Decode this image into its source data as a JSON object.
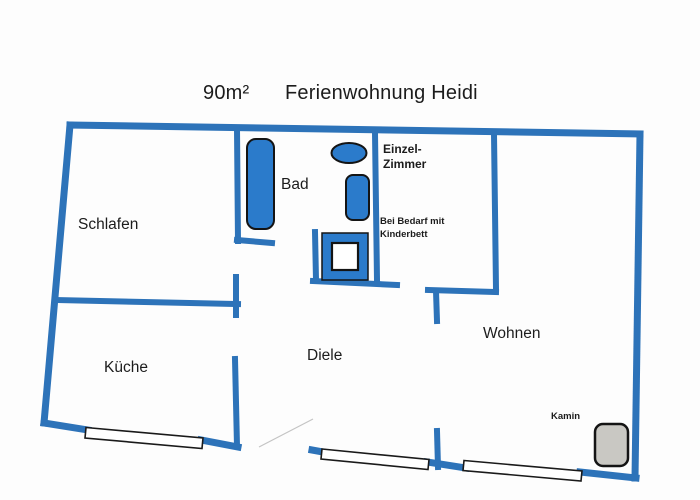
{
  "title": {
    "area": "90m²",
    "name": "Ferienwohnung Heidi"
  },
  "rooms": {
    "schlafen": {
      "label": "Schlafen"
    },
    "bad": {
      "label": "Bad"
    },
    "einzelzimmer": {
      "label_line1": "Einzel-",
      "label_line2": "Zimmer",
      "note_line1": "Bei Bedarf mit",
      "note_line2": "Kinderbett"
    },
    "kueche": {
      "label": "Küche"
    },
    "diele": {
      "label": "Diele"
    },
    "wohnen": {
      "label": "Wohnen"
    },
    "kamin": {
      "label": "Kamin"
    }
  },
  "fixtures": [
    "bathtub",
    "washbasin",
    "wc",
    "shower",
    "fireplace",
    "kitchen-window",
    "hall-window",
    "living-room-window",
    "entrance-door"
  ],
  "colors": {
    "wall": "#2d73b9",
    "fixture": "#2b7bcb",
    "fixture_outline": "#141414",
    "fireplace_fill": "#c9c8c3",
    "window_fill": "#ffffff",
    "window_outline": "#1a1a1a",
    "door_swing": "#c4c4c4",
    "text": "#1c1c1c",
    "background": "#fdfdfd"
  }
}
